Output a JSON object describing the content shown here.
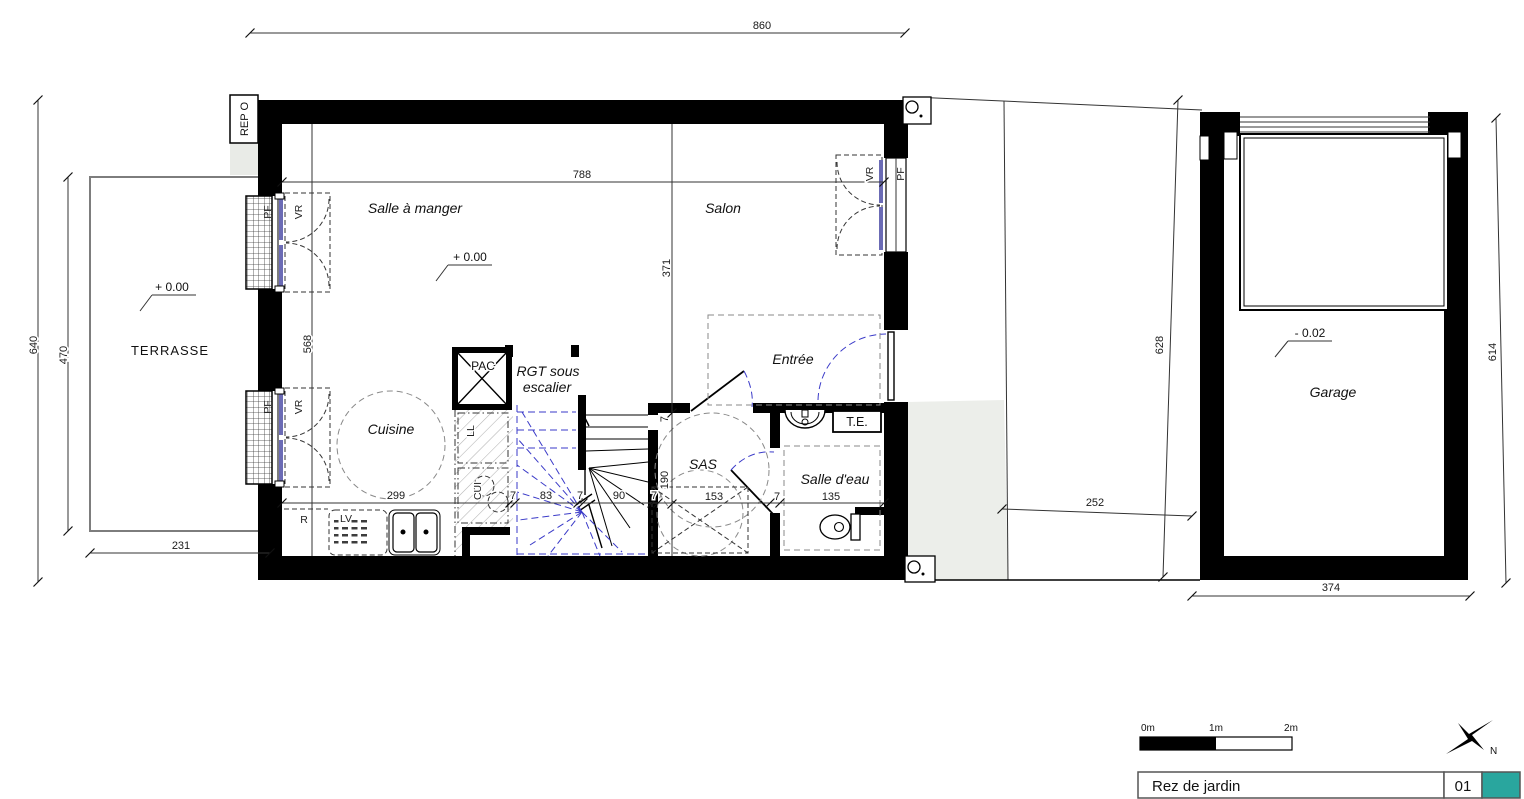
{
  "rooms": {
    "terrasse": "TERRASSE",
    "salle_a_manger": "Salle à manger",
    "salon": "Salon",
    "cuisine": "Cuisine",
    "rgt_line1": "RGT sous",
    "rgt_line2": "escalier",
    "entree": "Entrée",
    "sas": "SAS",
    "salle_deau": "Salle d'eau",
    "garage": "Garage"
  },
  "levels": {
    "zero": "+ 0.00",
    "garage": "- 0.02"
  },
  "equipment": {
    "pac": "PAC",
    "te": "T.E.",
    "ll": "LL",
    "cui": "CUI",
    "r": "R",
    "lv": "LV"
  },
  "openings": {
    "pf": "PF",
    "vr": "VR"
  },
  "marker": "REP O",
  "dims": {
    "top": "860",
    "outer_left": "640",
    "terrasse_h": "470",
    "terrasse_w": "231",
    "interior_w": "788",
    "salon_h": "371",
    "left_h": "568",
    "cuisine_w": "299",
    "w7": "7",
    "st83": "83",
    "st90": "90",
    "sas_w": "153",
    "sde_w": "135",
    "sas_h": "190",
    "garage_l": "628",
    "garage_r": "614",
    "garage_w": "374",
    "path_w": "252"
  },
  "scalebar": {
    "m0": "0m",
    "m1": "1m",
    "m2": "2m"
  },
  "titleblock": {
    "title": "Rez de jardin",
    "number": "01",
    "accent_color": "#29a69e"
  },
  "compass": {
    "north": "N"
  }
}
